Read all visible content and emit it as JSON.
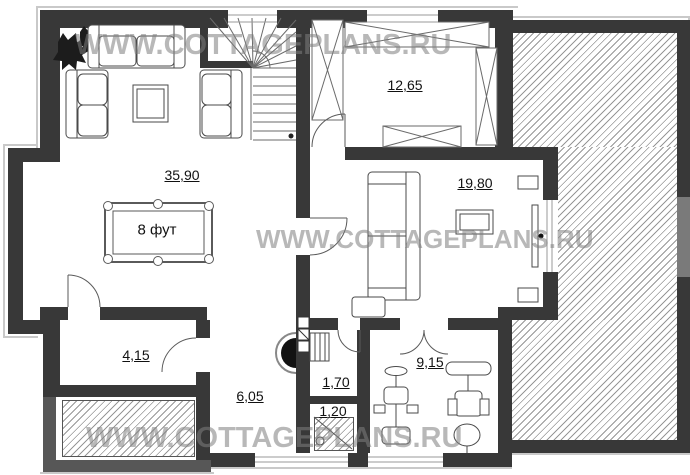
{
  "watermark": {
    "text": "WWW.COTTAGEPLANS.RU"
  },
  "rooms": {
    "living": {
      "area": "35,90"
    },
    "billiard": {
      "size": "8 фут"
    },
    "dressing": {
      "area": "12,65"
    },
    "bedroom": {
      "area": "19,80"
    },
    "storage": {
      "area": "4,15"
    },
    "hall": {
      "area": "6,05"
    },
    "wc": {
      "area": "1,70"
    },
    "shower": {
      "area": "1,20"
    },
    "gym": {
      "area": "9,15"
    }
  },
  "colors": {
    "wall": "#383838",
    "hatch_line": "#979797",
    "watermark": "#7d7d7d",
    "fireplace": "#121212"
  }
}
